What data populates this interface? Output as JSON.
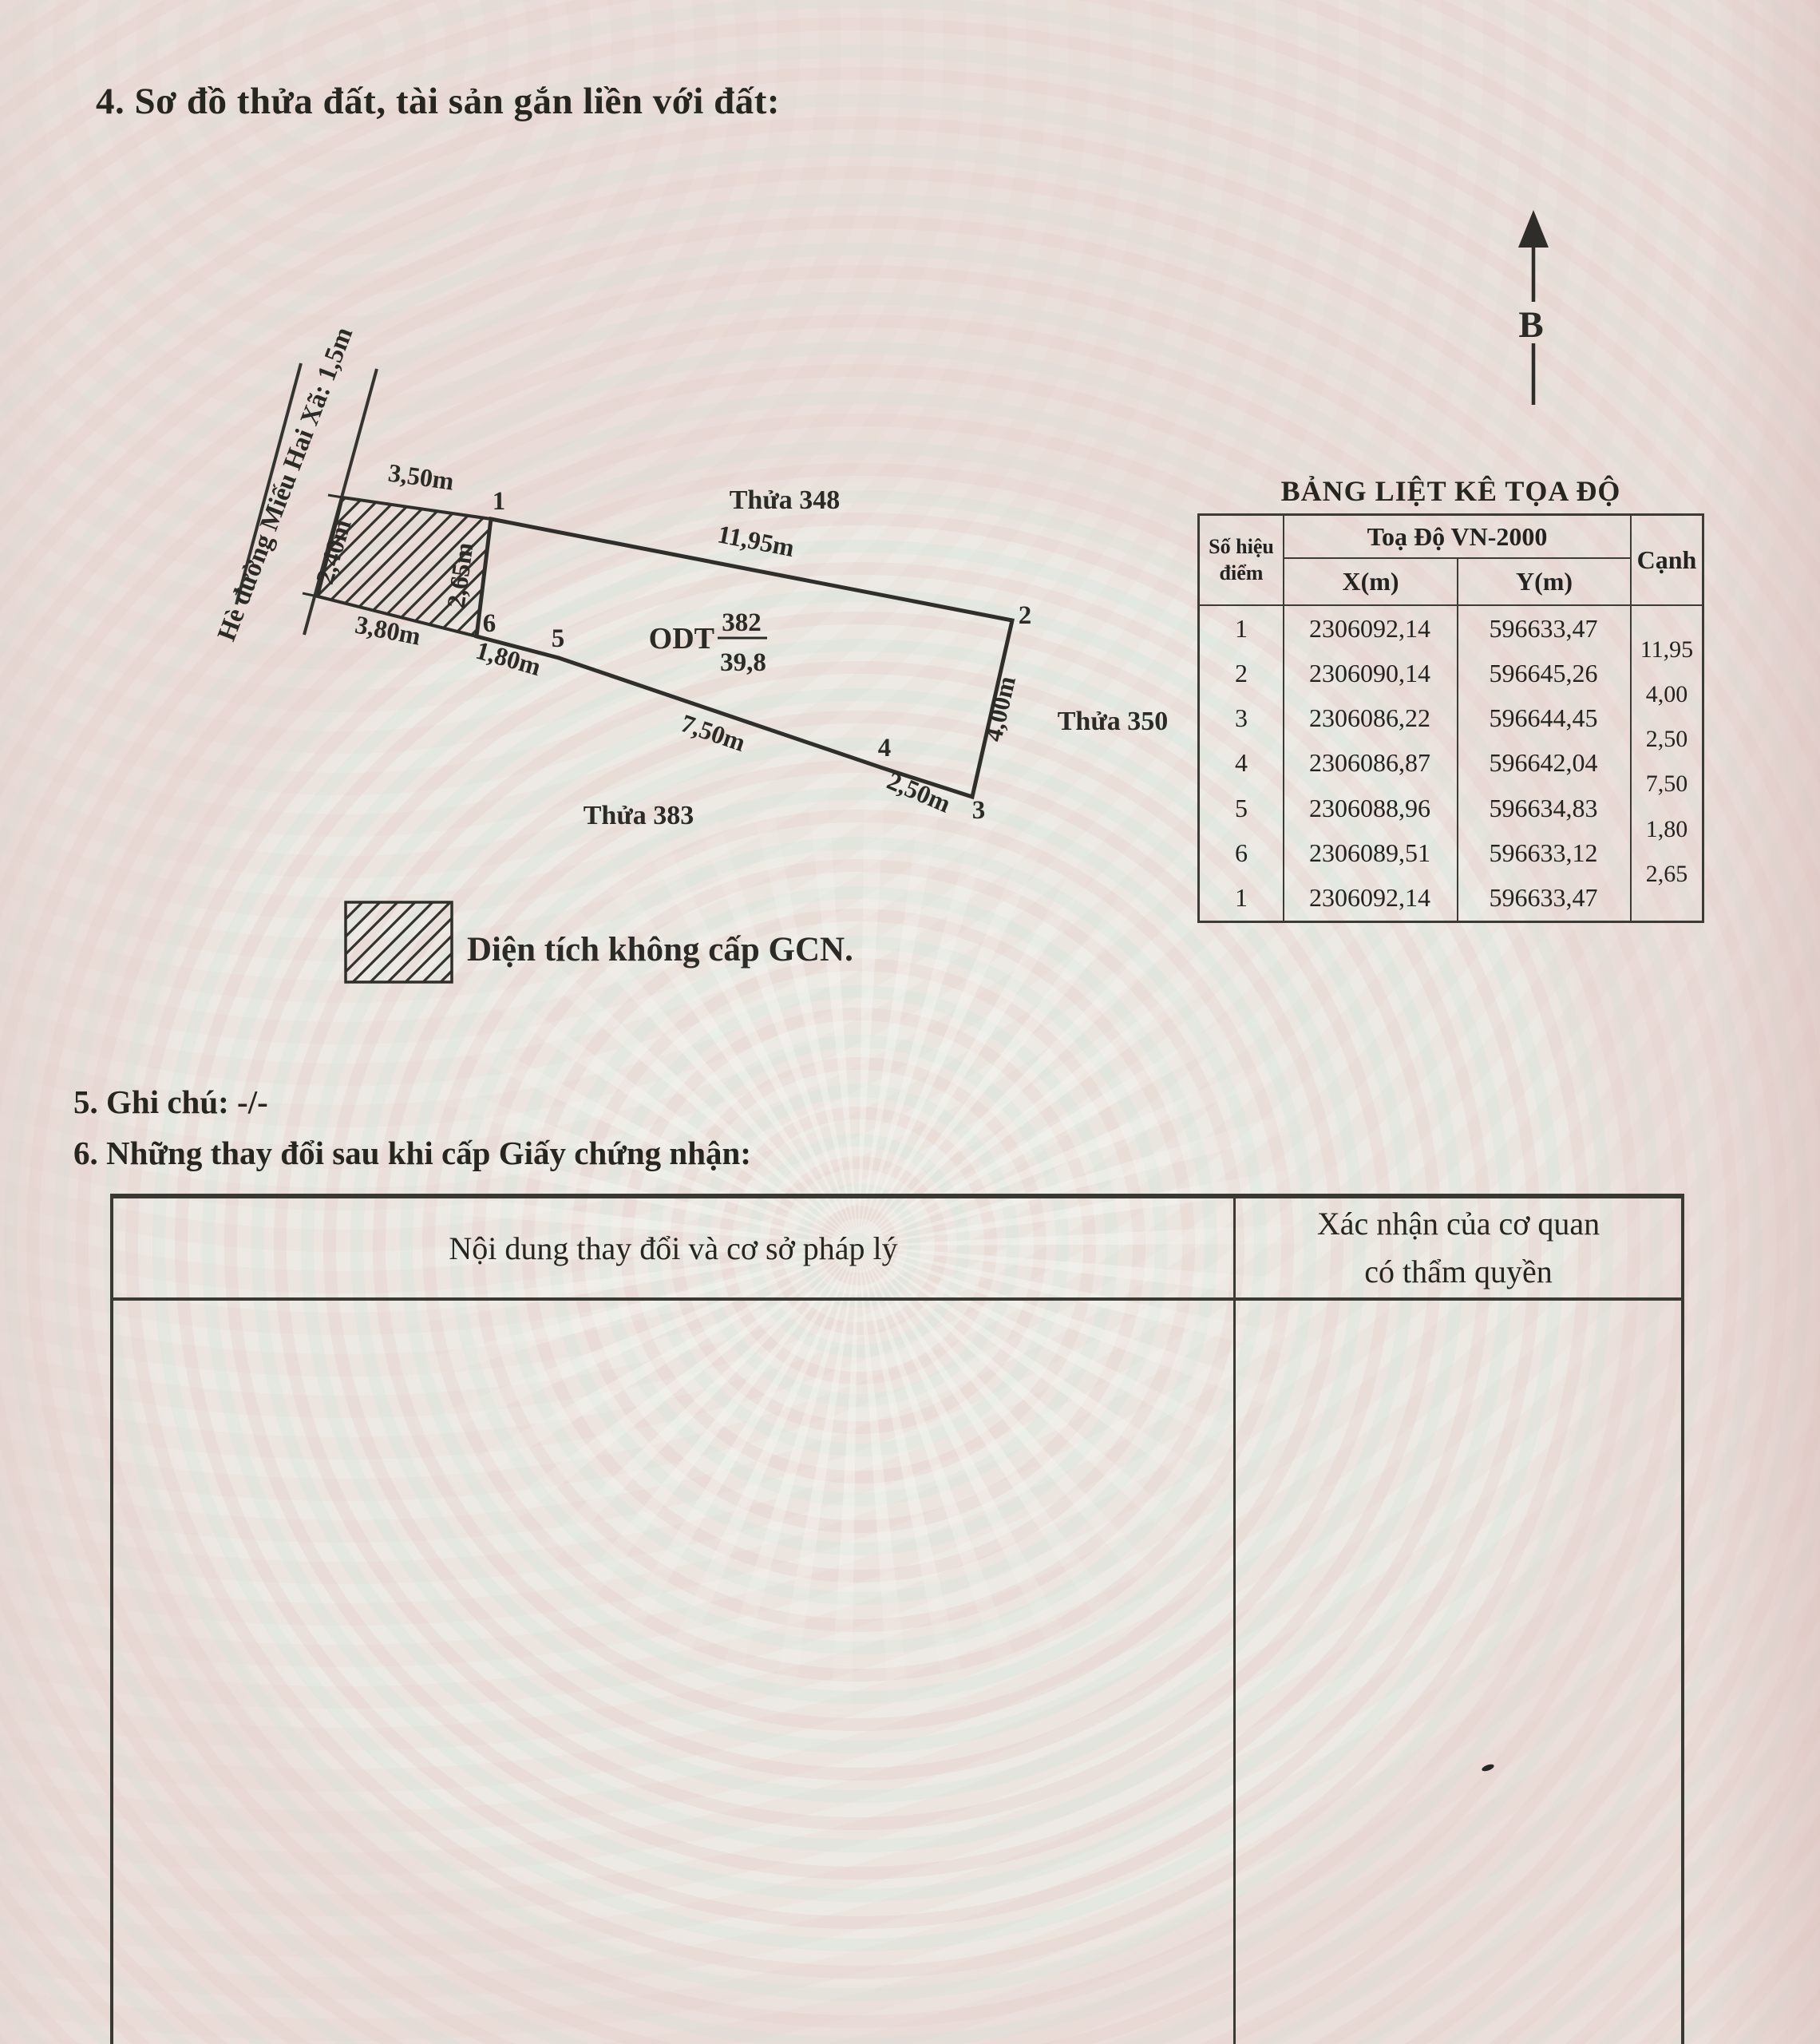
{
  "palette": {
    "paper": "#e8e0da",
    "ink": "#2c2b28",
    "pattern_pink": "#e9d8d4",
    "pattern_green": "#e1e9e2"
  },
  "document": {
    "section4_title": "4. Sơ đồ thửa đất, tài sản gắn liền với đất:",
    "section5_title": "5. Ghi chú: -/-",
    "section6_title": "6. Những thay đổi sau khi cấp Giấy chứng nhận:"
  },
  "compass": {
    "north_label": "B"
  },
  "diagram": {
    "road_label": "Hè đường Miếu Hai Xã: 1,5m",
    "adjacent_parcels": {
      "top": "Thửa 348",
      "right": "Thửa 350",
      "bottom": "Thửa 383"
    },
    "parcel": {
      "land_use_code": "ODT",
      "parcel_no": "382",
      "area": "39,8"
    },
    "vertices": {
      "v1": "1",
      "v2": "2",
      "v3": "3",
      "v4": "4",
      "v5": "5",
      "v6": "6"
    },
    "dims": {
      "hatch_top": "3,50m",
      "hatch_left": "2,40m",
      "hatch_right": "2,65m",
      "hatch_bottom": "3,80m",
      "e12": "11,95m",
      "e23": "4,00m",
      "e34": "2,50m",
      "e45": "7,50m",
      "e56": "1,80m"
    },
    "legend_label": "Diện tích không cấp GCN."
  },
  "coord_table": {
    "title": "BẢNG LIỆT KÊ TỌA ĐỘ",
    "headers": {
      "point": "Số hiệu điểm",
      "group": "Toạ Độ VN-2000",
      "x": "X(m)",
      "y": "Y(m)",
      "edge": "Cạnh"
    },
    "rows": [
      {
        "p": "1",
        "x": "2306092,14",
        "y": "596633,47"
      },
      {
        "p": "2",
        "x": "2306090,14",
        "y": "596645,26"
      },
      {
        "p": "3",
        "x": "2306086,22",
        "y": "596644,45"
      },
      {
        "p": "4",
        "x": "2306086,87",
        "y": "596642,04"
      },
      {
        "p": "5",
        "x": "2306088,96",
        "y": "596634,83"
      },
      {
        "p": "6",
        "x": "2306089,51",
        "y": "596633,12"
      },
      {
        "p": "1",
        "x": "2306092,14",
        "y": "596633,47"
      }
    ],
    "edges": [
      "11,95",
      "4,00",
      "2,50",
      "7,50",
      "1,80",
      "2,65"
    ]
  },
  "changes_table": {
    "col_content": "Nội dung thay đổi và cơ sở pháp lý",
    "col_confirm_line1": "Xác nhận của cơ quan",
    "col_confirm_line2": "có thẩm quyền"
  }
}
